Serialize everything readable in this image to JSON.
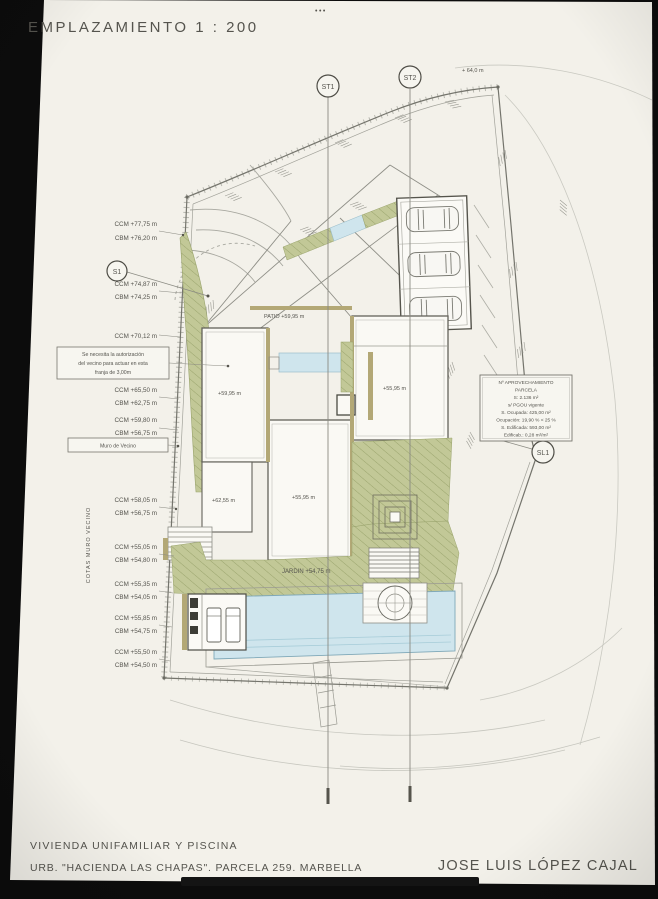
{
  "sheet": {
    "title": "EMPLAZAMIENTO  1 : 200",
    "corner_dots": "•••"
  },
  "markers": {
    "st1": "ST1",
    "st2": "ST2",
    "s1": "S1",
    "sl1": "SL1"
  },
  "elevations": {
    "top_right": "+ 64,0 m",
    "left_wall_axis": "COTAS MURO VECINO",
    "left_wall_labels": [
      "CCM +77,75 m",
      "CBM +76,20 m",
      "CCM +74,87 m",
      "CBM +74,25 m",
      "CCM +70,12 m",
      "CCM +65,50 m",
      "CBM +62,75 m",
      "CCM +59,80 m",
      "CBM +56,75 m",
      "CCM +58,05 m",
      "CBM +56,75 m",
      "CCM +55,05 m",
      "CBM +54,80 m",
      "CCM +55,35 m",
      "CBM +54,05 m",
      "CCM +55,85 m",
      "CBM +54,75 m",
      "CCM +55,50 m",
      "CBM +54,50 m"
    ]
  },
  "notes": {
    "neighbor_strip": [
      "Se necesita la autorización",
      "del vecino para actuar en esta",
      "franja de 3,00m"
    ],
    "neighbor_wall": "Muro de Vecino",
    "parameters_box": [
      "Nº APROVECHAMIENTO",
      "PARCELA",
      "S: 2.136 m²",
      "s/ PGOU vigente",
      "S. Ocupada: 425,00 m²",
      "Ocupación: 19,90 % < 25 %",
      "S. Edificada: 593,00 m²",
      "Edificab.: 0,28 m²/m²"
    ]
  },
  "plan_labels": {
    "patio": "PATIO +59,95 m",
    "room_left": "+59,95 m",
    "room_left_lower": "+62,55 m",
    "room_right": "+55,95 m",
    "room_center_lower": "+55,95 m",
    "garden": "JARDIN +54,75 m"
  },
  "title_block": {
    "line1": "VIVIENDA UNIFAMILIAR Y PISCINA",
    "line2": "URB. \"HACIENDA LAS CHAPAS\". PARCELA 259. MARBELLA",
    "architect": "JOSE LUIS LÓPEZ CAJAL"
  },
  "colors": {
    "paper": "#f3f1ea",
    "line": "#8e8e88",
    "wall": "#b3a876",
    "vegetation": "#bec68f",
    "water": "#cfe5ed",
    "text": "#4a4a46"
  }
}
